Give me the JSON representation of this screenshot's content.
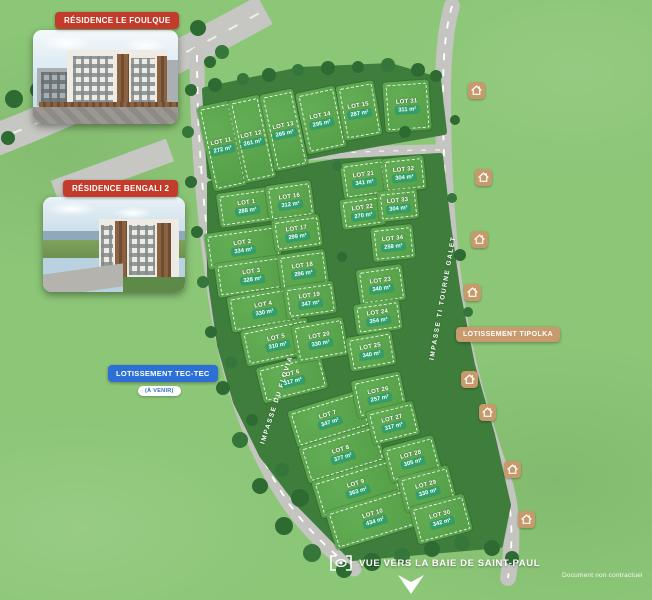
{
  "badges": {
    "residence_foulque": "RÉSIDENCE LE FOULQUE",
    "residence_bengali": "RÉSIDENCE BENGALI 2",
    "lotissement_tec_tec": "LOTISSEMENT TEC-TEC",
    "tec_tec_status": "(À VENIR)",
    "lotissement_tipolka": "LOTISSEMENT TIPOLKA"
  },
  "roads": {
    "left_road_label": "IMPASSE DU FLUVIA",
    "right_road_label": "IMPASSE TI TOURNE GALET"
  },
  "footer": {
    "view_caption": "VUE VERS LA BAIE DE SAINT-PAUL",
    "disclaimer": "Document non contractuel"
  },
  "colors": {
    "grass": "#8cc677",
    "lot_green": "#58a34b",
    "hedge_green": "#3e7d3b",
    "road_gray": "#c6c6c2",
    "badge_red": "#c23b2b",
    "badge_blue": "#2c6fd6",
    "badge_tan": "#c89a6c",
    "area_pill_green": "#2fa06d"
  },
  "lots": [
    {
      "name": "LOT 1",
      "area": "288 m²",
      "x": 247,
      "y": 207,
      "w": 58,
      "h": 34,
      "r": -8
    },
    {
      "name": "LOT 2",
      "area": "334 m²",
      "x": 243,
      "y": 247,
      "w": 74,
      "h": 36,
      "r": -8
    },
    {
      "name": "LOT 3",
      "area": "328 m²",
      "x": 252,
      "y": 276,
      "w": 72,
      "h": 34,
      "r": -8
    },
    {
      "name": "LOT 4",
      "area": "330 m²",
      "x": 264,
      "y": 309,
      "w": 70,
      "h": 36,
      "r": -10
    },
    {
      "name": "LOT 5",
      "area": "310 m²",
      "x": 277,
      "y": 342,
      "w": 68,
      "h": 36,
      "r": -12
    },
    {
      "name": "LOT 6",
      "area": "317 m²",
      "x": 292,
      "y": 378,
      "w": 66,
      "h": 36,
      "r": -14
    },
    {
      "name": "LOT 7",
      "area": "347 m²",
      "x": 329,
      "y": 419,
      "w": 76,
      "h": 38,
      "r": -17
    },
    {
      "name": "LOT 8",
      "area": "377 m²",
      "x": 342,
      "y": 454,
      "w": 80,
      "h": 38,
      "r": -17
    },
    {
      "name": "LOT 9",
      "area": "363 m²",
      "x": 357,
      "y": 488,
      "w": 84,
      "h": 38,
      "r": -17
    },
    {
      "name": "LOT 10",
      "area": "434 m²",
      "x": 374,
      "y": 518,
      "w": 90,
      "h": 40,
      "r": -17
    },
    {
      "name": "LOT 11",
      "area": "272 m²",
      "x": 222,
      "y": 146,
      "w": 34,
      "h": 86,
      "r": -12
    },
    {
      "name": "LOT 12",
      "area": "261 m²",
      "x": 252,
      "y": 139,
      "w": 32,
      "h": 84,
      "r": -12
    },
    {
      "name": "LOT 13",
      "area": "265 m²",
      "x": 284,
      "y": 130,
      "w": 34,
      "h": 78,
      "r": -12
    },
    {
      "name": "LOT 14",
      "area": "295 m²",
      "x": 321,
      "y": 120,
      "w": 40,
      "h": 62,
      "r": -12
    },
    {
      "name": "LOT 15",
      "area": "287 m²",
      "x": 359,
      "y": 110,
      "w": 38,
      "h": 55,
      "r": -10
    },
    {
      "name": "LOT 16",
      "area": "312 m²",
      "x": 290,
      "y": 201,
      "w": 46,
      "h": 36,
      "r": -8
    },
    {
      "name": "LOT 17",
      "area": "299 m²",
      "x": 297,
      "y": 233,
      "w": 48,
      "h": 32,
      "r": -8
    },
    {
      "name": "LOT 18",
      "area": "296 m²",
      "x": 303,
      "y": 270,
      "w": 48,
      "h": 36,
      "r": -8
    },
    {
      "name": "LOT 19",
      "area": "347 m²",
      "x": 310,
      "y": 300,
      "w": 50,
      "h": 32,
      "r": -8
    },
    {
      "name": "LOT 20",
      "area": "330 m²",
      "x": 320,
      "y": 340,
      "w": 52,
      "h": 38,
      "r": -10
    },
    {
      "name": "LOT 21",
      "area": "341 m²",
      "x": 364,
      "y": 179,
      "w": 44,
      "h": 36,
      "r": -8
    },
    {
      "name": "LOT 22",
      "area": "270 m²",
      "x": 363,
      "y": 212,
      "w": 44,
      "h": 30,
      "r": -8
    },
    {
      "name": "LOT 23",
      "area": "340 m²",
      "x": 381,
      "y": 285,
      "w": 46,
      "h": 36,
      "r": -8
    },
    {
      "name": "LOT 24",
      "area": "354 m²",
      "x": 378,
      "y": 317,
      "w": 46,
      "h": 30,
      "r": -8
    },
    {
      "name": "LOT 25",
      "area": "340 m²",
      "x": 371,
      "y": 351,
      "w": 46,
      "h": 34,
      "r": -10
    },
    {
      "name": "LOT 26",
      "area": "257 m²",
      "x": 379,
      "y": 395,
      "w": 50,
      "h": 38,
      "r": -12
    },
    {
      "name": "LOT 27",
      "area": "317 m²",
      "x": 393,
      "y": 423,
      "w": 48,
      "h": 34,
      "r": -14
    },
    {
      "name": "LOT 28",
      "area": "305 m²",
      "x": 412,
      "y": 459,
      "w": 52,
      "h": 36,
      "r": -15
    },
    {
      "name": "LOT 29",
      "area": "330 m²",
      "x": 427,
      "y": 489,
      "w": 52,
      "h": 36,
      "r": -15
    },
    {
      "name": "LOT 30",
      "area": "342 m²",
      "x": 441,
      "y": 519,
      "w": 56,
      "h": 38,
      "r": -15
    },
    {
      "name": "LOT 31",
      "area": "311 m²",
      "x": 407,
      "y": 106,
      "w": 46,
      "h": 50,
      "r": -4
    },
    {
      "name": "LOT 32",
      "area": "304 m²",
      "x": 404,
      "y": 174,
      "w": 42,
      "h": 34,
      "r": -6
    },
    {
      "name": "LOT 33",
      "area": "304 m²",
      "x": 398,
      "y": 205,
      "w": 40,
      "h": 30,
      "r": -6
    },
    {
      "name": "LOT 34",
      "area": "259 m²",
      "x": 393,
      "y": 243,
      "w": 42,
      "h": 34,
      "r": -6
    }
  ],
  "house_icons": [
    {
      "x": 476,
      "y": 90
    },
    {
      "x": 483,
      "y": 177
    },
    {
      "x": 479,
      "y": 239
    },
    {
      "x": 472,
      "y": 292
    },
    {
      "x": 469,
      "y": 379
    },
    {
      "x": 487,
      "y": 412
    },
    {
      "x": 512,
      "y": 469
    },
    {
      "x": 526,
      "y": 519
    }
  ]
}
